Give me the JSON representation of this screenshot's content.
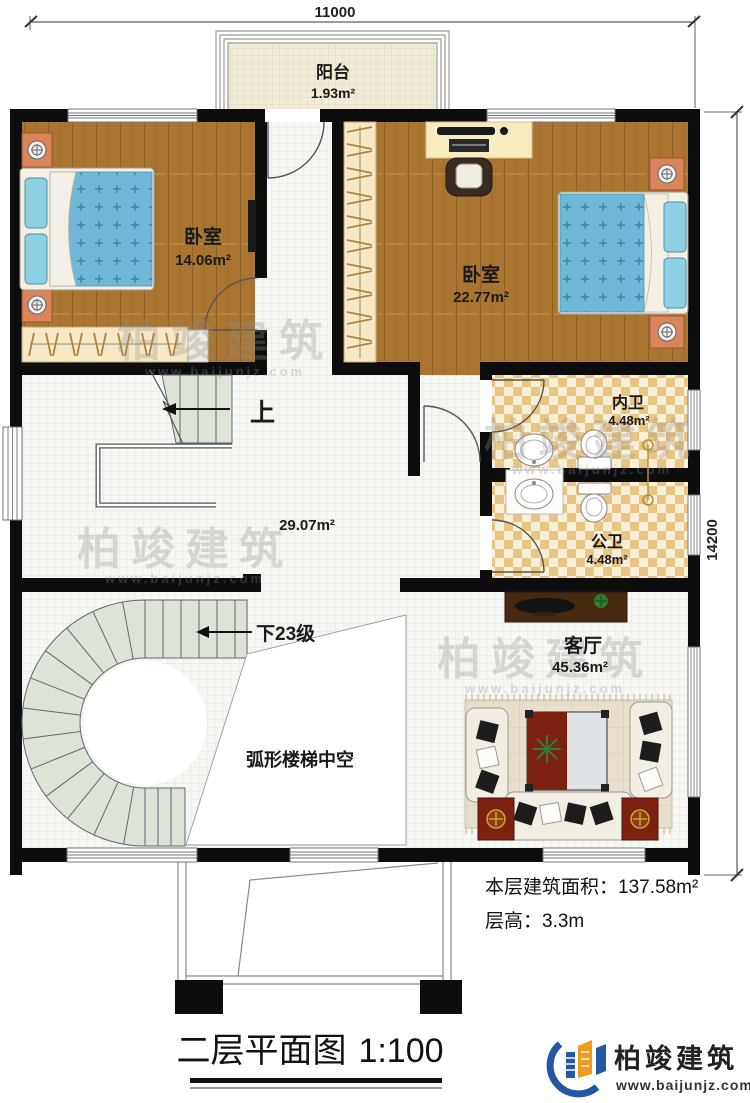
{
  "dimensions": {
    "width_mm": "11000",
    "height_mm": "14200"
  },
  "rooms": {
    "balcony": {
      "label": "阳台",
      "area": "1.93m²"
    },
    "bedroom_small": {
      "label": "卧室",
      "area": "14.06m²"
    },
    "bedroom_large": {
      "label": "卧室",
      "area": "22.77m²"
    },
    "ensuite_bathroom": {
      "label": "内卫",
      "area": "4.48m²"
    },
    "shared_bathroom": {
      "label": "公卫",
      "area": "4.48m²"
    },
    "hall": {
      "area": "29.07m²"
    },
    "living_room": {
      "label": "客厅",
      "area": "45.36m²"
    },
    "stair_void": {
      "label": "弧形楼梯中空"
    }
  },
  "stairs": {
    "up": "上",
    "down": "下23级"
  },
  "notes": {
    "floor_area_label": "本层建筑面积：",
    "floor_area_value": "137.58m²",
    "floor_height_label": "层高：",
    "floor_height_value": "3.3m"
  },
  "title": {
    "name": "二层平面图",
    "scale": "1:100"
  },
  "brand": {
    "logo_text": "柏竣建筑",
    "website": "www.baijunjz.com"
  },
  "watermark": {
    "text": "柏竣建筑",
    "website": "www.baijunjz.com"
  },
  "colors": {
    "wall": "#0d0d0d",
    "wood": "#aa7531",
    "tile": "#f6f6f2",
    "stair": "#dce3d7",
    "checker": "#e9c583",
    "quilt": "#6fb8d8",
    "accent_orange": "#d9845a",
    "logo_blue": "#2456a4",
    "logo_orange": "#f29b1d"
  }
}
